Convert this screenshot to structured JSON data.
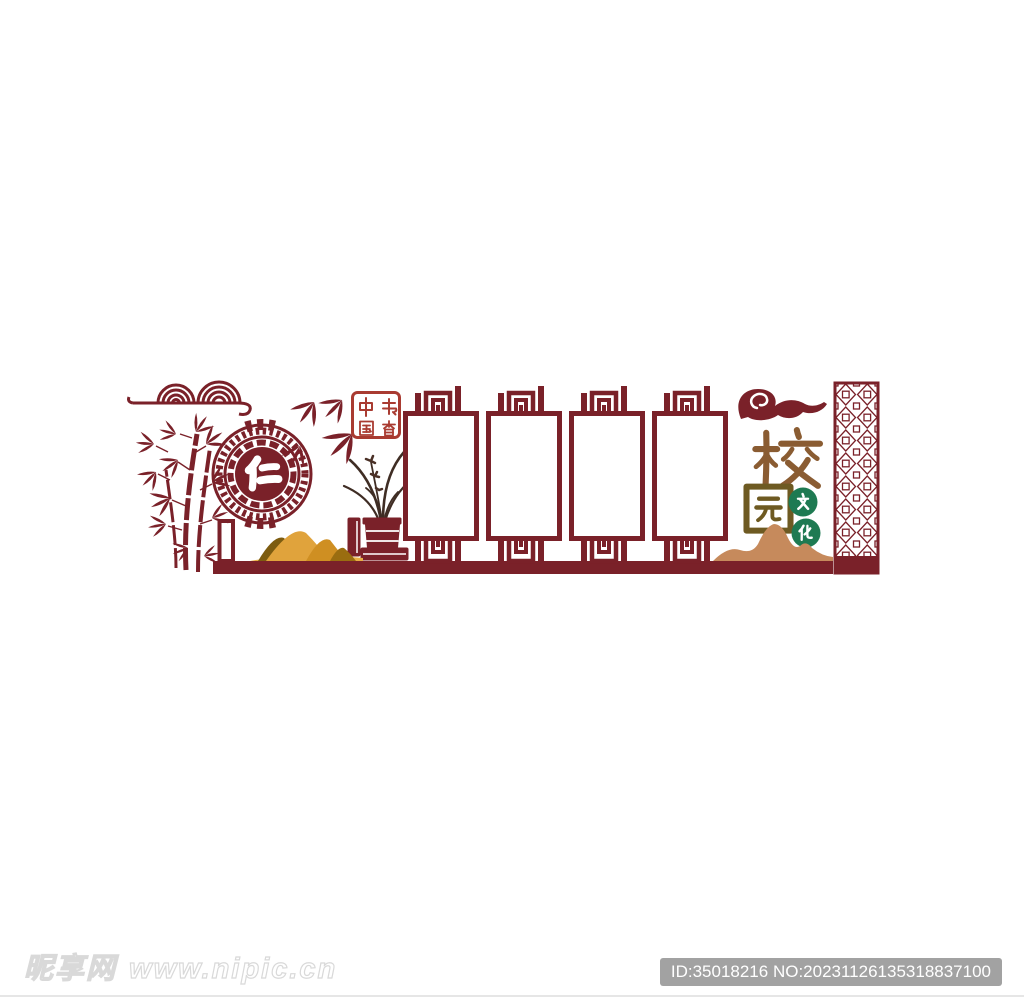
{
  "page": {
    "background_color": "#ffffff",
    "description": "Chinese classical campus culture wall vector design preview"
  },
  "colors": {
    "maroon": "#7a2129",
    "seal_red": "#a93b31",
    "title_brown": "#8a5c32",
    "title_olive": "#6e5a22",
    "badge_green": "#1e7a52",
    "mountain_tan": "#c68a5c",
    "mountain_gold": "#e0a33c",
    "mountain_dark_gold": "#7d5c10",
    "plant_dark": "#3f2d24",
    "id_badge_gray": "#a2a2a2"
  },
  "artwork": {
    "medallion": {
      "character": "仁"
    },
    "seal": {
      "label": "中国书香",
      "char_top_left": "中",
      "char_top_right": "书",
      "char_bottom_left": "国",
      "char_bottom_right": "香"
    },
    "photo_frames": {
      "count": 4
    },
    "title": {
      "char_top": "校",
      "char_bottom": "园"
    },
    "culture_badges": {
      "char_top": "文",
      "char_bottom": "化"
    }
  },
  "watermark": {
    "site_name": "昵享网",
    "site_url": "www.nipic.cn"
  },
  "id_badge": {
    "text": "ID:35018216 NO:20231126135318837100"
  }
}
